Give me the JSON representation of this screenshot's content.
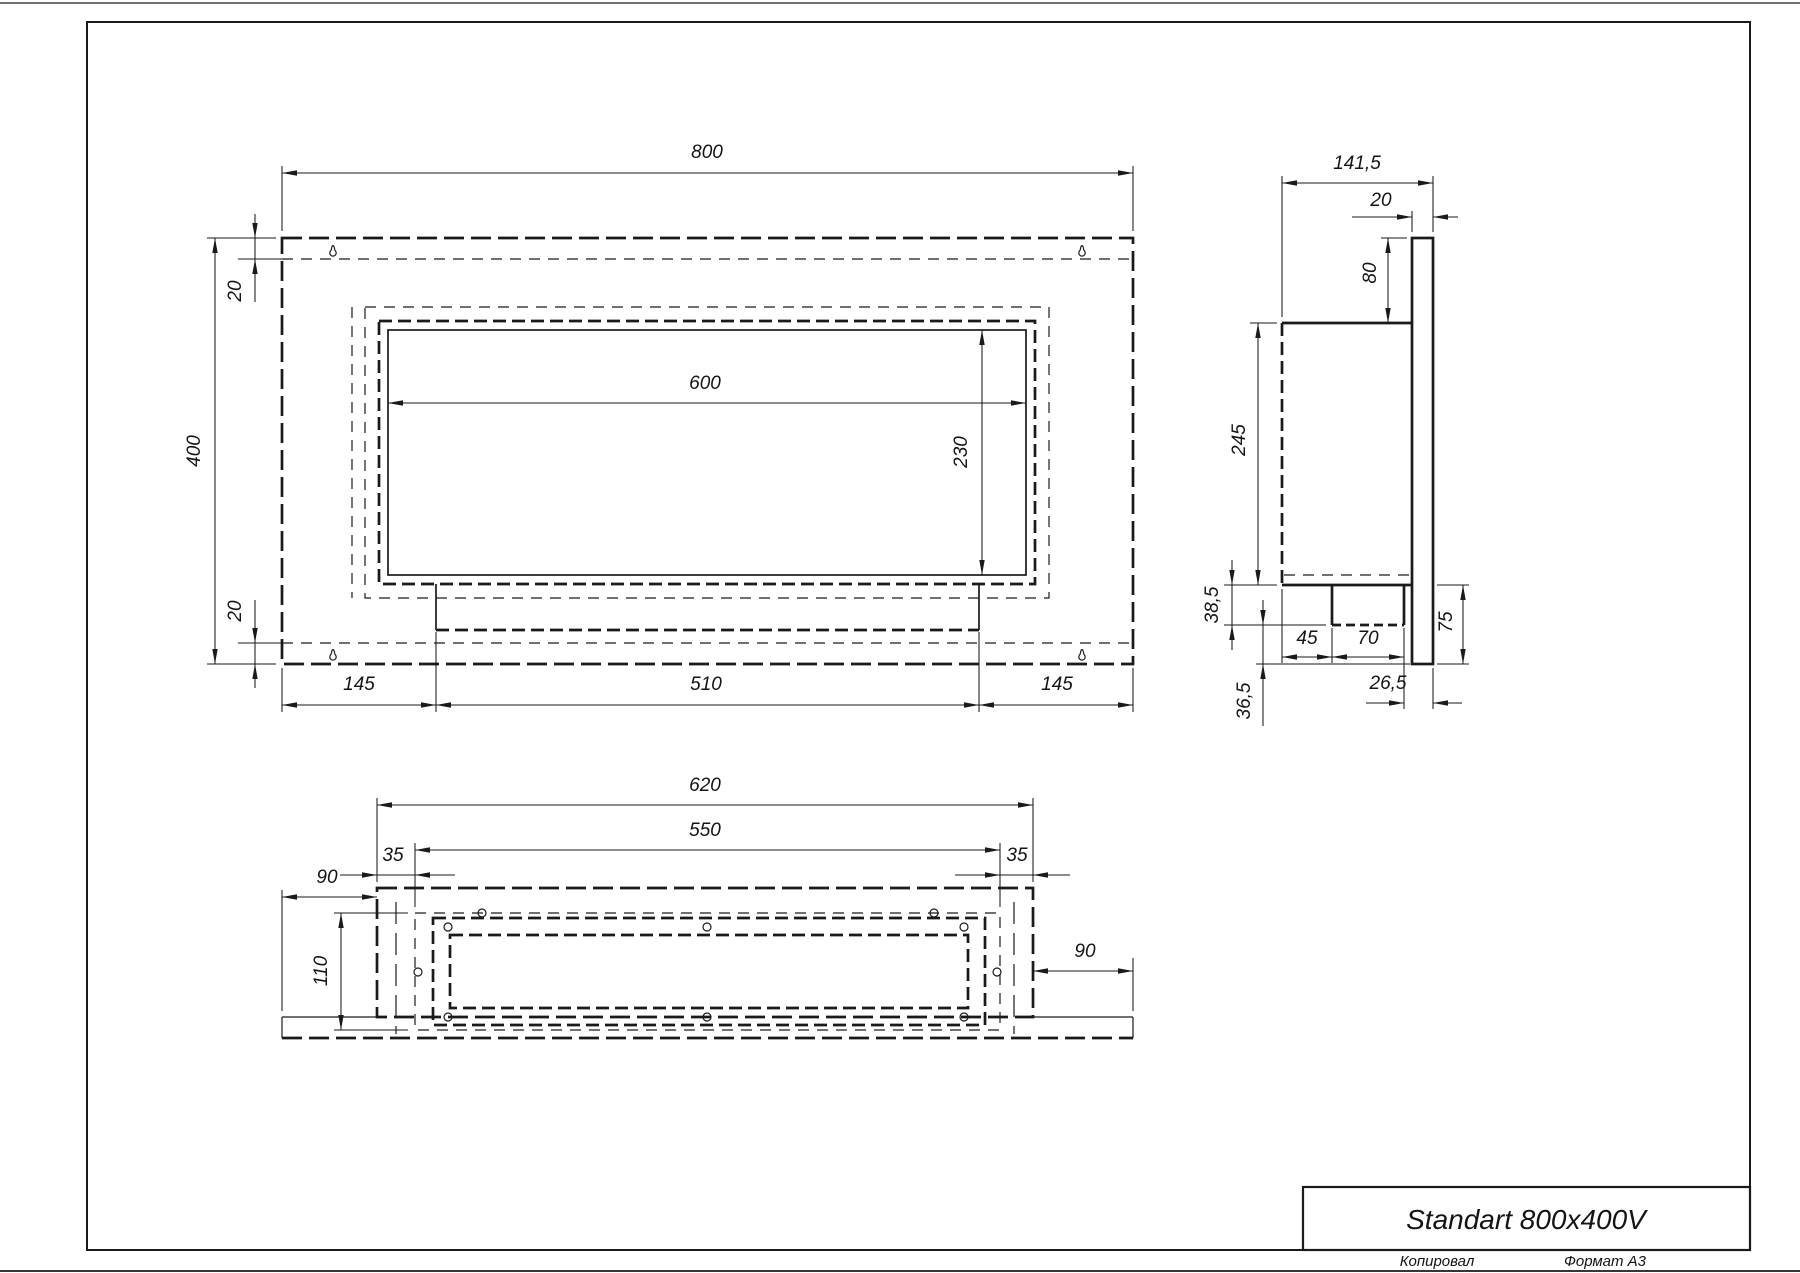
{
  "title_block": {
    "title": "Standart 800x400V"
  },
  "footer": {
    "copied": "Копировал",
    "format": "Формат А3"
  },
  "dims": {
    "front": {
      "width": "800",
      "height": "400",
      "top_inset": "20",
      "bottom_inset": "20",
      "opening_width": "600",
      "opening_height": "230",
      "margin_left": "145",
      "tray_width": "510",
      "margin_right": "145"
    },
    "side": {
      "depth": "141,5",
      "panel_thickness": "20",
      "top_overhang": "80",
      "body_height": "245",
      "burner_drop": "38,5",
      "burner_offset": "45",
      "burner_width": "70",
      "bottom_overhang": "75",
      "front_gap": "26,5",
      "bottom_gap": "36,5"
    },
    "bottom": {
      "body_width": "620",
      "tray_length": "550",
      "margin_left": "35",
      "margin_right": "35",
      "side_offset_left": "90",
      "side_offset_right": "90",
      "opening_depth": "110"
    }
  }
}
